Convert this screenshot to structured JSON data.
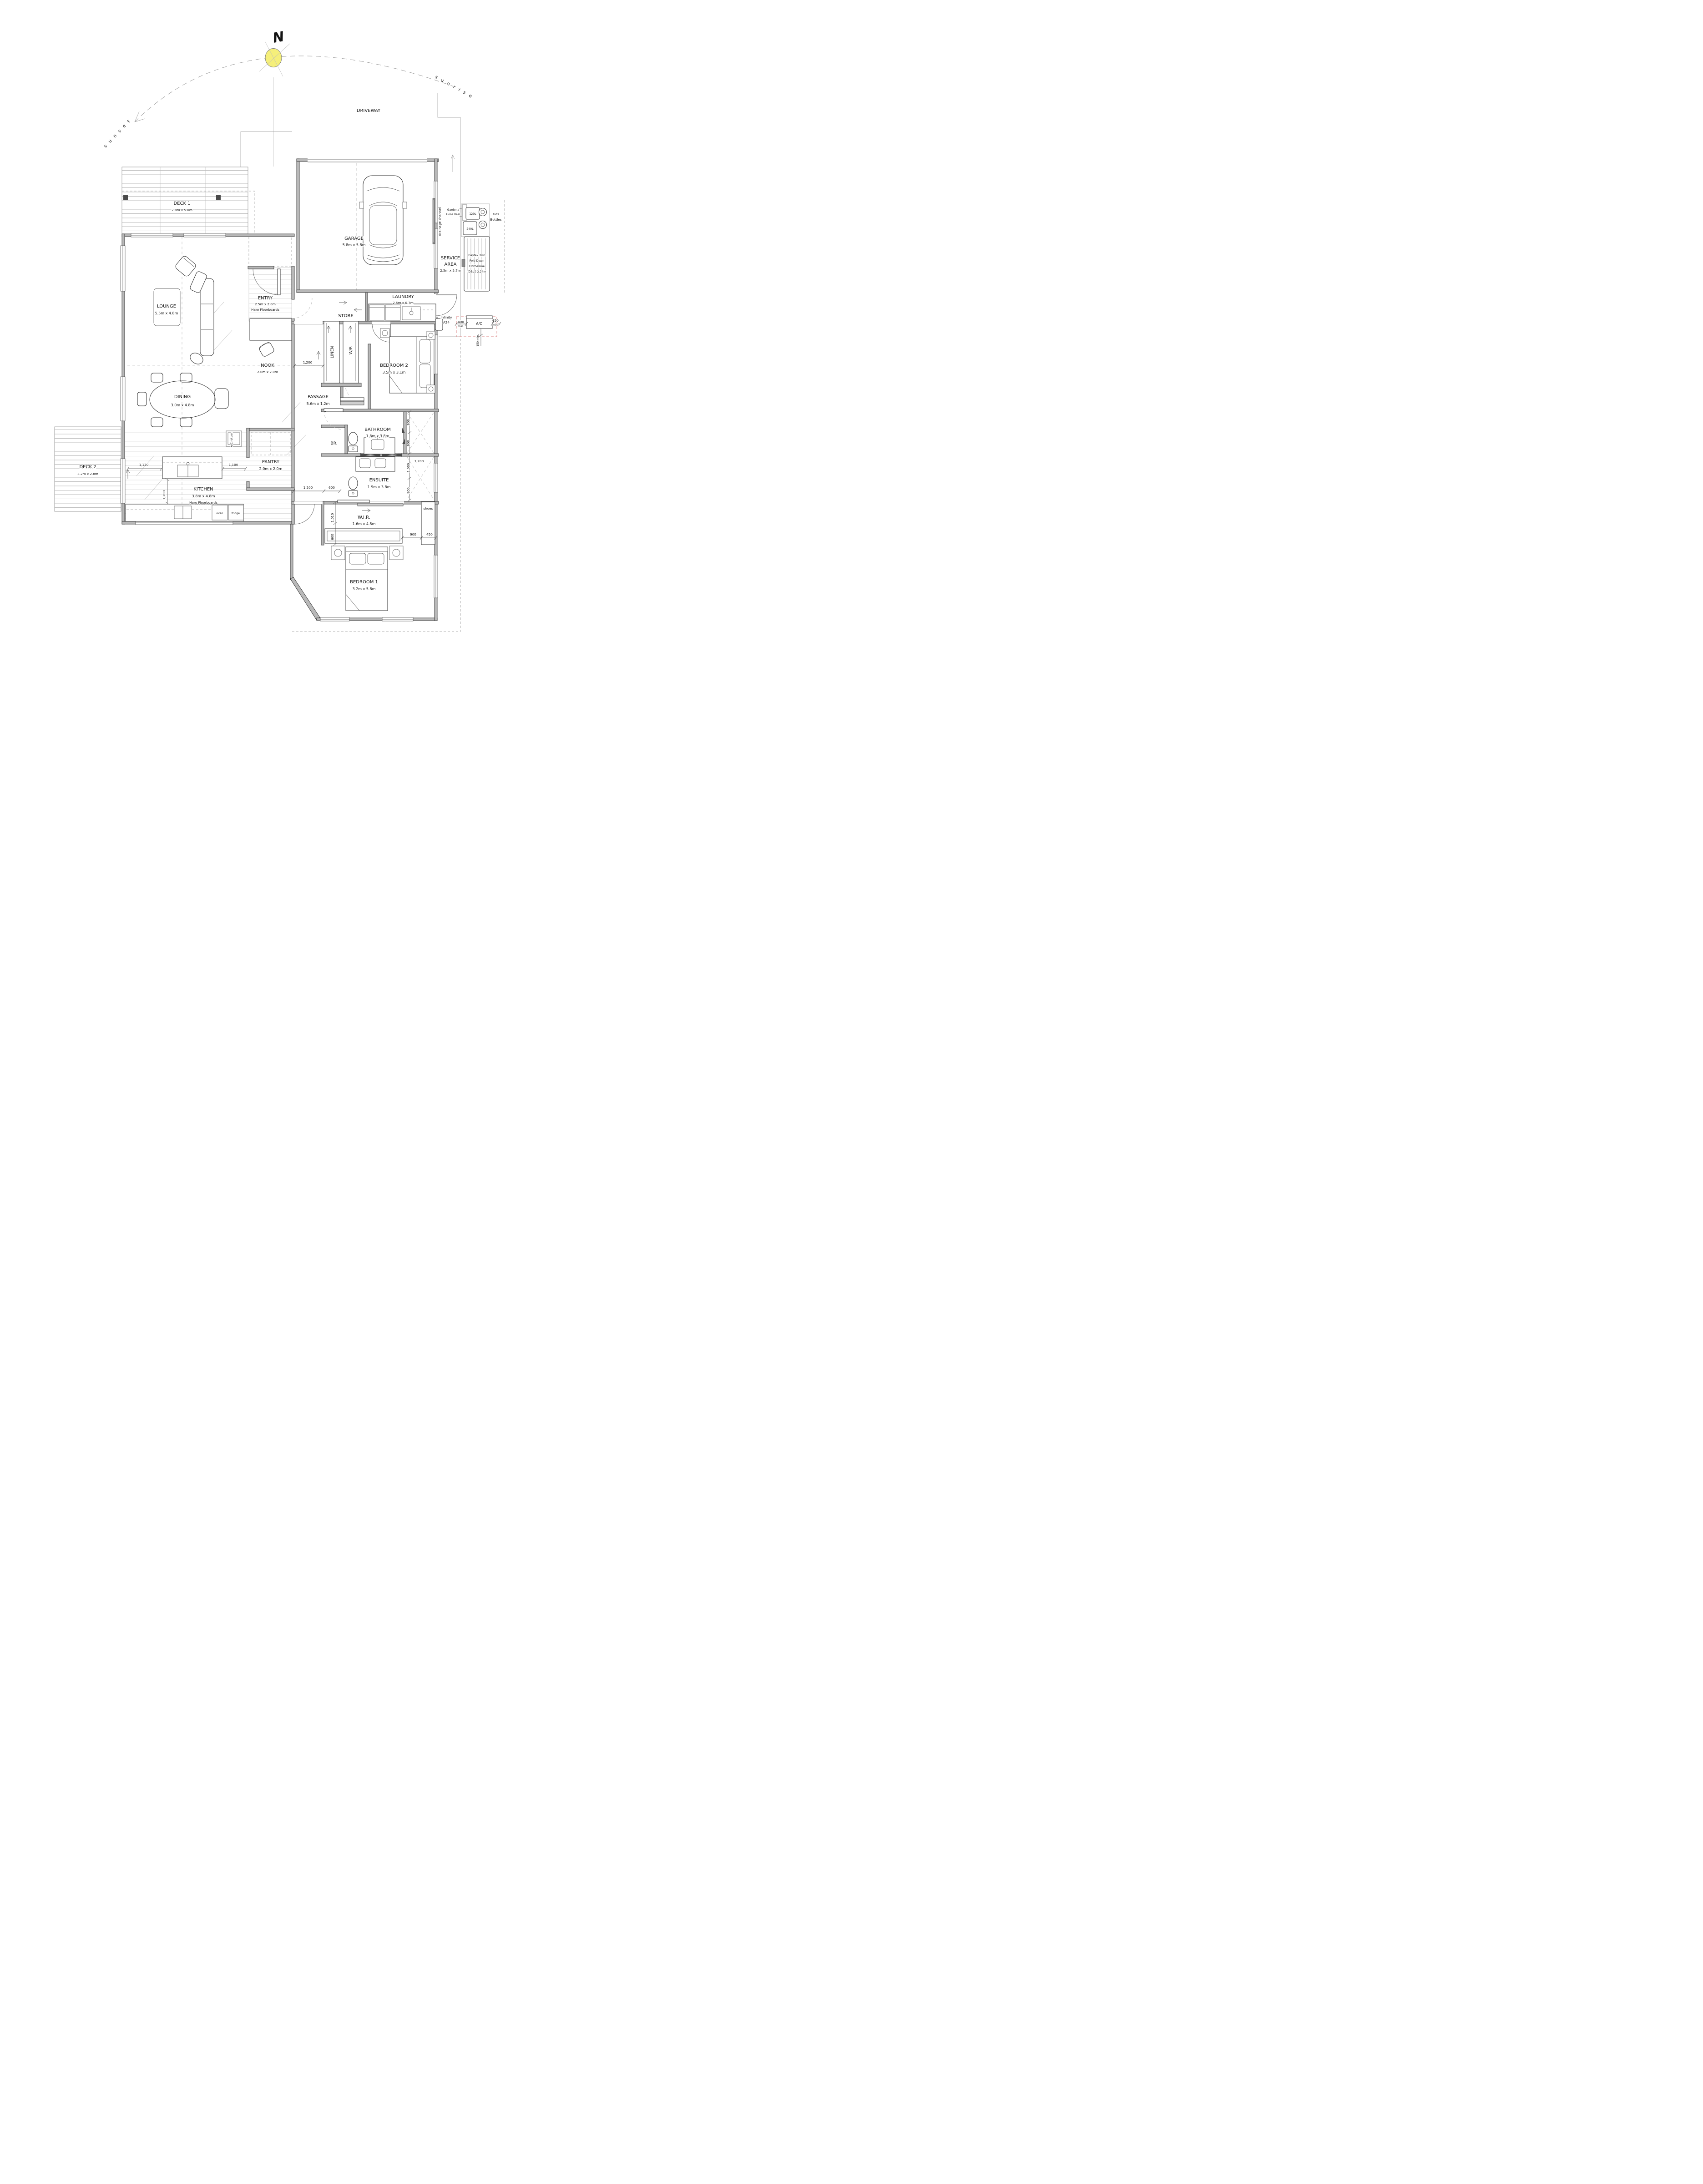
{
  "colors": {
    "sun": "#f5ef7a",
    "ac_dash": "#dd8a8a"
  },
  "compass": {
    "north": "N",
    "sunrise": "s u n r i s e",
    "sunset": "s u n s e t"
  },
  "site": {
    "driveway": "DRIVEWAY"
  },
  "rooms": {
    "deck1": {
      "name": "DECK 1",
      "dims": "2.8m x 5.0m"
    },
    "garage": {
      "name": "GARAGE",
      "dims": "5.8m x 5.8m"
    },
    "service": {
      "line1": "SERVICE",
      "line2": "AREA",
      "dims": "2.5m x 5.7m"
    },
    "entry": {
      "name": "ENTRY",
      "dims": "2.5m x 2.0m",
      "floor": "Haro Floorboards"
    },
    "lounge": {
      "name": "LOUNGE",
      "dims": "5.5m x 4.8m"
    },
    "store": {
      "name": "STORE"
    },
    "laundry": {
      "name": "LAUNDRY",
      "dims": "2.5m x 0.7m"
    },
    "nook": {
      "name": "NOOK",
      "dims": "2.0m x 2.0m"
    },
    "linen": {
      "name": "LINEN"
    },
    "wr": {
      "name": "W/R"
    },
    "bedroom2": {
      "name": "BEDROOM 2",
      "dims": "3.5m x 3.1m"
    },
    "passage": {
      "name": "PASSAGE",
      "dims": "5.6m x 1.2m"
    },
    "dining": {
      "name": "DINING",
      "dims": "3.0m x 4.8m"
    },
    "bathroom": {
      "name": "BATHROOM",
      "dims": "1.8m x 3.8m"
    },
    "br": {
      "name": "BR."
    },
    "ensuite": {
      "name": "ENSUITE",
      "dims": "1.9m x 3.8m"
    },
    "wir": {
      "name": "W.I.R.",
      "dims": "1.6m x 4.5m"
    },
    "kitchen": {
      "name": "KITCHEN",
      "dims": "3.8m x 4.8m",
      "floor": "Haro Floorboards"
    },
    "pantry": {
      "name": "PANTRY",
      "dims": "2.0m x 2.0m"
    },
    "deck2": {
      "name": "DECK 2",
      "dims": "3.2m x 2.8m"
    },
    "bedroom1": {
      "name": "BEDROOM 1",
      "dims": "3.2m x 5.8m"
    }
  },
  "fixtures": {
    "drainage": "drainage channel",
    "gardena1": "Gardena",
    "gardena2": "Hose Reel",
    "bin120": "120L",
    "bin240": "240L",
    "gas1": "Gas",
    "gas2": "Bottles",
    "clothes1": "Daytek Twin",
    "clothes2": "Fold Down",
    "clothes3": "Clothesline",
    "clothes4": "(DBL.) 2.24m",
    "infinity1": "Infinity",
    "infinity2": "A24",
    "ac": "A/C",
    "ac_400": "400",
    "ac_150": "150",
    "ac_min": "min.",
    "ac_150min": "150 min.",
    "ac_return": "A/C return",
    "oven": "oven",
    "fridge": "fridge",
    "shoes": "shoes"
  },
  "dims": {
    "d1200": "1,200",
    "d1120": "1,120",
    "d1100": "1,100",
    "d900": "900",
    "d450": "450",
    "d600": "600",
    "d1010": "1,010",
    "d1000": "1,000"
  }
}
